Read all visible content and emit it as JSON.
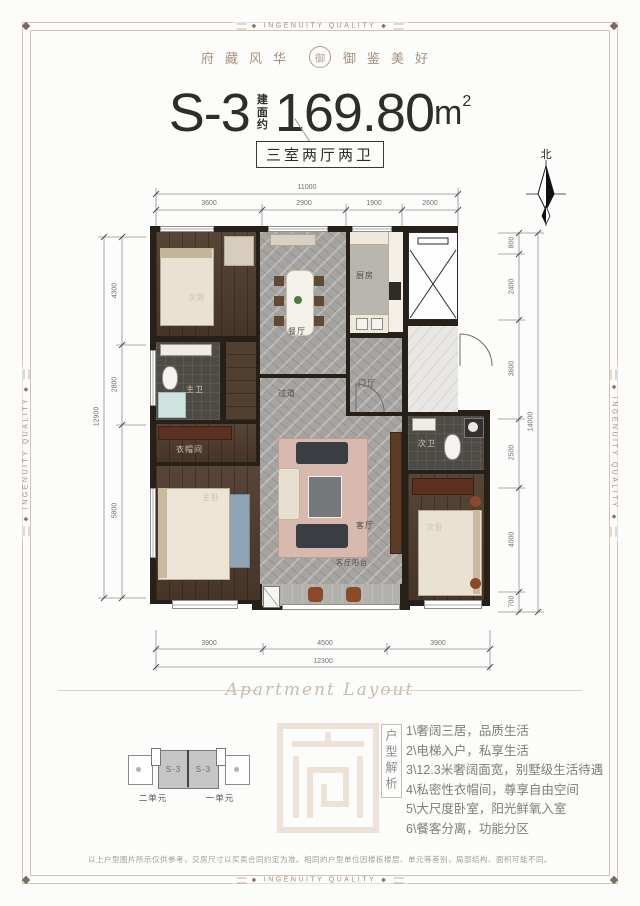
{
  "frame": {
    "border_label": "INGENUITY QUALITY"
  },
  "header": {
    "left": "府藏风华",
    "right": "御鉴美好",
    "seal_char": "御"
  },
  "title": {
    "model": "S-3",
    "area_prefix": "建面约",
    "area_value": "169.80",
    "area_unit": "m",
    "area_sup": "2",
    "badge": "三室两厅两卫"
  },
  "compass": {
    "north": "北"
  },
  "plan": {
    "rooms": {
      "bedroom_n": "次卧",
      "dining": "餐厅",
      "kitchen": "厨房",
      "foyer": "门厅",
      "hallway": "过道",
      "master_bath": "主卫",
      "cloak": "衣帽间",
      "master_bed": "主卧",
      "living": "客厅",
      "bath2": "次卫",
      "bedroom_s": "次卧",
      "balcony": "客厅阳台"
    },
    "dims": {
      "top_total": "11000",
      "top": [
        "3600",
        "2900",
        "1900",
        "2600"
      ],
      "left_total": "12900",
      "left": [
        "4300",
        "2800",
        "5800"
      ],
      "right_total": "14000",
      "right": [
        "800",
        "2400",
        "3600",
        "2500",
        "4000",
        "700"
      ],
      "bottom": [
        "3900",
        "4500",
        "3900"
      ],
      "bottom_total": "12300"
    }
  },
  "divider": {
    "script_text": "Apartment Layout"
  },
  "unit_key": {
    "block_left": "S-3",
    "block_right": "S-3",
    "label_left": "二单元",
    "label_right": "一单元"
  },
  "analysis": {
    "heading": "户型解析",
    "items": [
      "1\\奢阔三居，品质生活",
      "2\\电梯入户，私享生活",
      "3\\12.3米奢阔面宽，别墅级生活待遇",
      "4\\私密性衣帽间，尊享自由空间",
      "5\\大尺度卧室，阳光鲜氧入室",
      "6\\餐客分离，功能分区"
    ]
  },
  "disclaimer": "以上户型图片所示仅供参考，交房尺寸以买卖合同约定为准。相同的户型单位因楼栋楼层、单元等差别，局部结构、面积可能不同。",
  "colors": {
    "accent_wood": "#5d3122",
    "wall": "#262019",
    "marble": "#a6a4a0",
    "frame": "#d2c4b8"
  }
}
